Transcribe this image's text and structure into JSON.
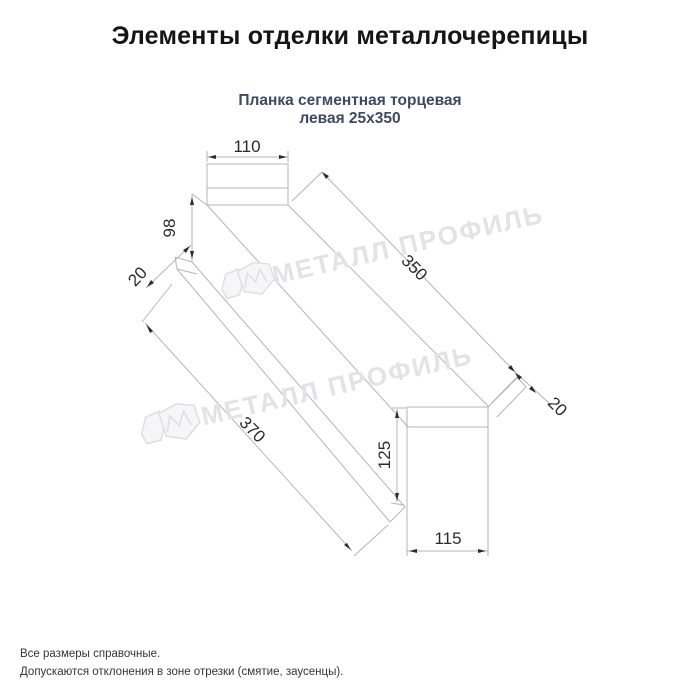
{
  "header": {
    "title": "Элементы отделки металлочерепицы",
    "subtitle_line1": "Планка сегментная торцевая",
    "subtitle_line2": "левая 25х350"
  },
  "drawing": {
    "type": "technical-diagram",
    "dimensions": {
      "top_flange_width": "110",
      "left_end_height": "98",
      "left_lip": "20",
      "top_edge_length": "350",
      "bottom_edge_length": "370",
      "right_end_height": "125",
      "bottom_flange_width": "115",
      "right_lip": "20"
    },
    "watermark_text": "МЕТАЛЛ ПРОФИЛЬ"
  },
  "footer": {
    "note1": "Все размеры справочные.",
    "note2": "Допускаются отклонения в зоне отрезки (смятие, заусенцы)."
  },
  "colors": {
    "title": "#151515",
    "subtitle": "#3d4a63",
    "drawing_line": "#b5b5b5",
    "dimension_text": "#2b2b2b",
    "watermark": "#e3e3e7"
  }
}
